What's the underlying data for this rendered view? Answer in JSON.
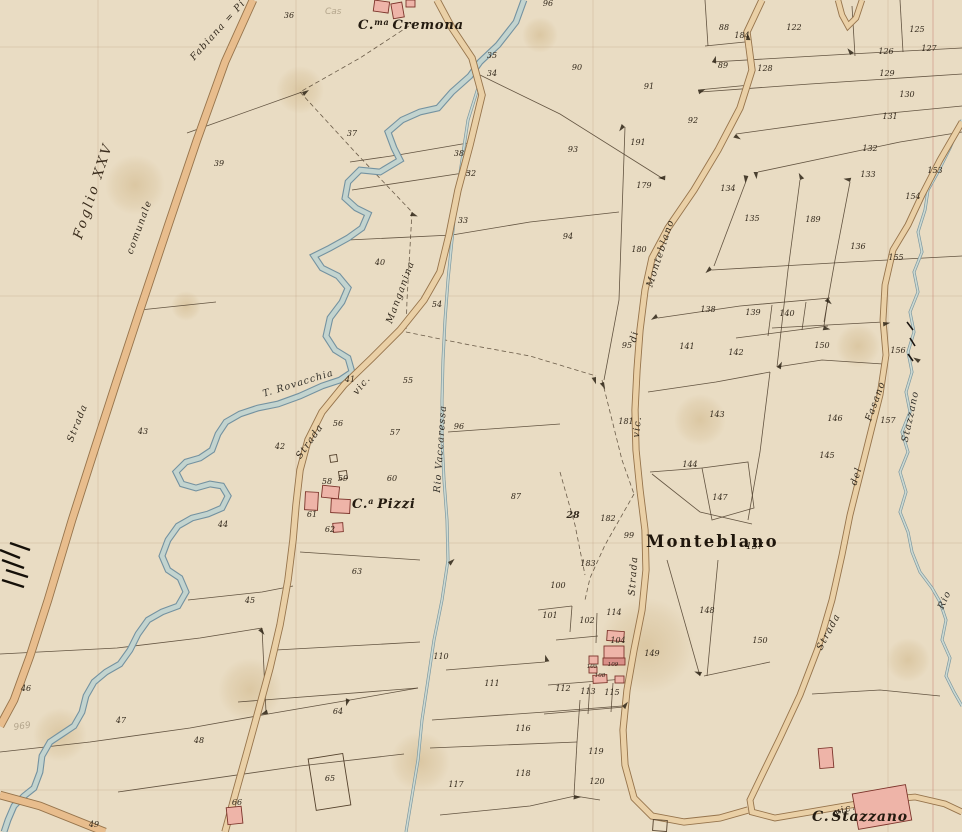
{
  "map": {
    "sheet_label": "Foglio XXV",
    "places": {
      "cremona": {
        "prefix": "C.",
        "sup": "ma",
        "name": "Cremona"
      },
      "pizzi": {
        "prefix": "C.",
        "sup": "a",
        "name": "Pizzi"
      },
      "monteblano": {
        "name": "Monteblano",
        "number": "137"
      },
      "stazzano": {
        "prefix": "C.",
        "name": "Stazzano"
      }
    },
    "road_labels": [
      {
        "text": "Strada",
        "x": 80,
        "y": 424,
        "rot": -68
      },
      {
        "text": "comunale",
        "x": 142,
        "y": 228,
        "rot": -70
      },
      {
        "text": "Fabiana = Pi",
        "x": 220,
        "y": 32,
        "rot": -48
      },
      {
        "text": "Strada",
        "x": 312,
        "y": 443,
        "rot": -55
      },
      {
        "text": "vic.",
        "x": 364,
        "y": 387,
        "rot": -50
      },
      {
        "text": "Manganina",
        "x": 403,
        "y": 293,
        "rot": -70
      },
      {
        "text": "Monteblano",
        "x": 663,
        "y": 254,
        "rot": -72
      },
      {
        "text": "di",
        "x": 637,
        "y": 337,
        "rot": -78
      },
      {
        "text": "vic.",
        "x": 640,
        "y": 427,
        "rot": -84
      },
      {
        "text": "Strada",
        "x": 636,
        "y": 576,
        "rot": -86
      },
      {
        "text": "Strada",
        "x": 831,
        "y": 633,
        "rot": -62
      },
      {
        "text": "del",
        "x": 859,
        "y": 477,
        "rot": -72
      },
      {
        "text": "Fasano",
        "x": 878,
        "y": 402,
        "rot": -70
      },
      {
        "text": "vic.",
        "x": 846,
        "y": 812,
        "rot": -18
      }
    ],
    "water_labels": [
      {
        "text": "T. Rovacchia",
        "x": 299,
        "y": 386,
        "rot": -17
      },
      {
        "text": "Rio Vaccaressa",
        "x": 443,
        "y": 449,
        "rot": -86
      },
      {
        "text": "Stazzano",
        "x": 913,
        "y": 417,
        "rot": -78
      },
      {
        "text": "Rio",
        "x": 947,
        "y": 601,
        "rot": -65
      }
    ],
    "pencil_marks": [
      {
        "text": "969",
        "x": 14,
        "y": 730,
        "rot": -8
      },
      {
        "text": "Cas",
        "x": 325,
        "y": 14,
        "rot": 0
      }
    ],
    "parcel_numbers": [
      {
        "n": "36",
        "x": 289,
        "y": 18
      },
      {
        "n": "96",
        "x": 548,
        "y": 6
      },
      {
        "n": "35",
        "x": 492,
        "y": 58
      },
      {
        "n": "34",
        "x": 492,
        "y": 76
      },
      {
        "n": "90",
        "x": 577,
        "y": 70
      },
      {
        "n": "91",
        "x": 649,
        "y": 89
      },
      {
        "n": "92",
        "x": 693,
        "y": 123
      },
      {
        "n": "93",
        "x": 573,
        "y": 152
      },
      {
        "n": "191",
        "x": 638,
        "y": 145
      },
      {
        "n": "179",
        "x": 644,
        "y": 188
      },
      {
        "n": "94",
        "x": 568,
        "y": 239
      },
      {
        "n": "180",
        "x": 639,
        "y": 252
      },
      {
        "n": "37",
        "x": 352,
        "y": 136
      },
      {
        "n": "38",
        "x": 459,
        "y": 156
      },
      {
        "n": "32",
        "x": 471,
        "y": 176
      },
      {
        "n": "39",
        "x": 219,
        "y": 166
      },
      {
        "n": "33",
        "x": 463,
        "y": 223
      },
      {
        "n": "40",
        "x": 380,
        "y": 265
      },
      {
        "n": "54",
        "x": 437,
        "y": 307
      },
      {
        "n": "95",
        "x": 627,
        "y": 348
      },
      {
        "n": "41",
        "x": 350,
        "y": 382
      },
      {
        "n": "55",
        "x": 408,
        "y": 383
      },
      {
        "n": "56",
        "x": 338,
        "y": 426
      },
      {
        "n": "57",
        "x": 395,
        "y": 435
      },
      {
        "n": "96",
        "x": 459,
        "y": 429
      },
      {
        "n": "42",
        "x": 280,
        "y": 449
      },
      {
        "n": "43",
        "x": 143,
        "y": 434
      },
      {
        "n": "87",
        "x": 516,
        "y": 499
      },
      {
        "n": "58",
        "x": 327,
        "y": 484
      },
      {
        "n": "59",
        "x": 343,
        "y": 481
      },
      {
        "n": "60",
        "x": 392,
        "y": 481
      },
      {
        "n": "61",
        "x": 312,
        "y": 517
      },
      {
        "n": "62",
        "x": 330,
        "y": 532
      },
      {
        "n": "44",
        "x": 223,
        "y": 527
      },
      {
        "n": "63",
        "x": 357,
        "y": 574
      },
      {
        "n": "45",
        "x": 250,
        "y": 603
      },
      {
        "n": "46",
        "x": 26,
        "y": 691
      },
      {
        "n": "47",
        "x": 121,
        "y": 723
      },
      {
        "n": "48",
        "x": 199,
        "y": 743
      },
      {
        "n": "49",
        "x": 94,
        "y": 827
      },
      {
        "n": "64",
        "x": 338,
        "y": 714
      },
      {
        "n": "65",
        "x": 330,
        "y": 781
      },
      {
        "n": "66",
        "x": 237,
        "y": 805
      },
      {
        "n": "110",
        "x": 441,
        "y": 659
      },
      {
        "n": "117",
        "x": 456,
        "y": 787
      },
      {
        "n": "88",
        "x": 724,
        "y": 30
      },
      {
        "n": "184",
        "x": 742,
        "y": 38
      },
      {
        "n": "122",
        "x": 794,
        "y": 30
      },
      {
        "n": "125",
        "x": 917,
        "y": 32
      },
      {
        "n": "126",
        "x": 886,
        "y": 54
      },
      {
        "n": "127",
        "x": 929,
        "y": 51
      },
      {
        "n": "89",
        "x": 723,
        "y": 68
      },
      {
        "n": "128",
        "x": 765,
        "y": 71
      },
      {
        "n": "129",
        "x": 887,
        "y": 76
      },
      {
        "n": "130",
        "x": 907,
        "y": 97
      },
      {
        "n": "131",
        "x": 890,
        "y": 119
      },
      {
        "n": "132",
        "x": 870,
        "y": 151
      },
      {
        "n": "133",
        "x": 868,
        "y": 177
      },
      {
        "n": "153",
        "x": 935,
        "y": 173
      },
      {
        "n": "154",
        "x": 913,
        "y": 199
      },
      {
        "n": "134",
        "x": 728,
        "y": 191
      },
      {
        "n": "135",
        "x": 752,
        "y": 221
      },
      {
        "n": "189",
        "x": 813,
        "y": 222
      },
      {
        "n": "136",
        "x": 858,
        "y": 249
      },
      {
        "n": "155",
        "x": 896,
        "y": 260
      },
      {
        "n": "138",
        "x": 708,
        "y": 312
      },
      {
        "n": "139",
        "x": 753,
        "y": 315
      },
      {
        "n": "140",
        "x": 787,
        "y": 316
      },
      {
        "n": "141",
        "x": 687,
        "y": 349
      },
      {
        "n": "142",
        "x": 736,
        "y": 355
      },
      {
        "n": "150",
        "x": 822,
        "y": 348
      },
      {
        "n": "156",
        "x": 898,
        "y": 353
      },
      {
        "n": "143",
        "x": 717,
        "y": 417
      },
      {
        "n": "181",
        "x": 626,
        "y": 424
      },
      {
        "n": "146",
        "x": 835,
        "y": 421
      },
      {
        "n": "157",
        "x": 888,
        "y": 423
      },
      {
        "n": "144",
        "x": 690,
        "y": 467
      },
      {
        "n": "145",
        "x": 827,
        "y": 458
      },
      {
        "n": "147",
        "x": 720,
        "y": 500
      },
      {
        "n": "28",
        "x": 573,
        "y": 518,
        "s": "big"
      },
      {
        "n": "182",
        "x": 608,
        "y": 521
      },
      {
        "n": "99",
        "x": 629,
        "y": 538
      },
      {
        "n": "183",
        "x": 588,
        "y": 566
      },
      {
        "n": "100",
        "x": 558,
        "y": 588
      },
      {
        "n": "101",
        "x": 550,
        "y": 618
      },
      {
        "n": "102",
        "x": 587,
        "y": 623
      },
      {
        "n": "114",
        "x": 614,
        "y": 615
      },
      {
        "n": "104",
        "x": 618,
        "y": 643
      },
      {
        "n": "105",
        "x": 592,
        "y": 668,
        "s": "t"
      },
      {
        "n": "108",
        "x": 600,
        "y": 677,
        "s": "t"
      },
      {
        "n": "109",
        "x": 613,
        "y": 666,
        "s": "t"
      },
      {
        "n": "111",
        "x": 492,
        "y": 686
      },
      {
        "n": "112",
        "x": 563,
        "y": 691
      },
      {
        "n": "113",
        "x": 588,
        "y": 694
      },
      {
        "n": "115",
        "x": 612,
        "y": 695
      },
      {
        "n": "116",
        "x": 523,
        "y": 731
      },
      {
        "n": "119",
        "x": 596,
        "y": 754
      },
      {
        "n": "118",
        "x": 523,
        "y": 776
      },
      {
        "n": "120",
        "x": 597,
        "y": 784
      },
      {
        "n": "148",
        "x": 707,
        "y": 613
      },
      {
        "n": "149",
        "x": 652,
        "y": 656
      },
      {
        "n": "150",
        "x": 760,
        "y": 643
      }
    ],
    "colors": {
      "paper": "#e9dcc3",
      "road_fill": "#ead0a6",
      "road_main_fill": "#e8bd8d",
      "road_casing": "#96744c",
      "stream_fill": "#c3d4cf",
      "stream_casing": "#7492a0",
      "parcel_line": "#4b3c2a",
      "building_fill": "#eeb4a8",
      "building_stroke": "#7c342b",
      "stain": "#c9a96e",
      "section_line": "#cb8d7d"
    }
  }
}
